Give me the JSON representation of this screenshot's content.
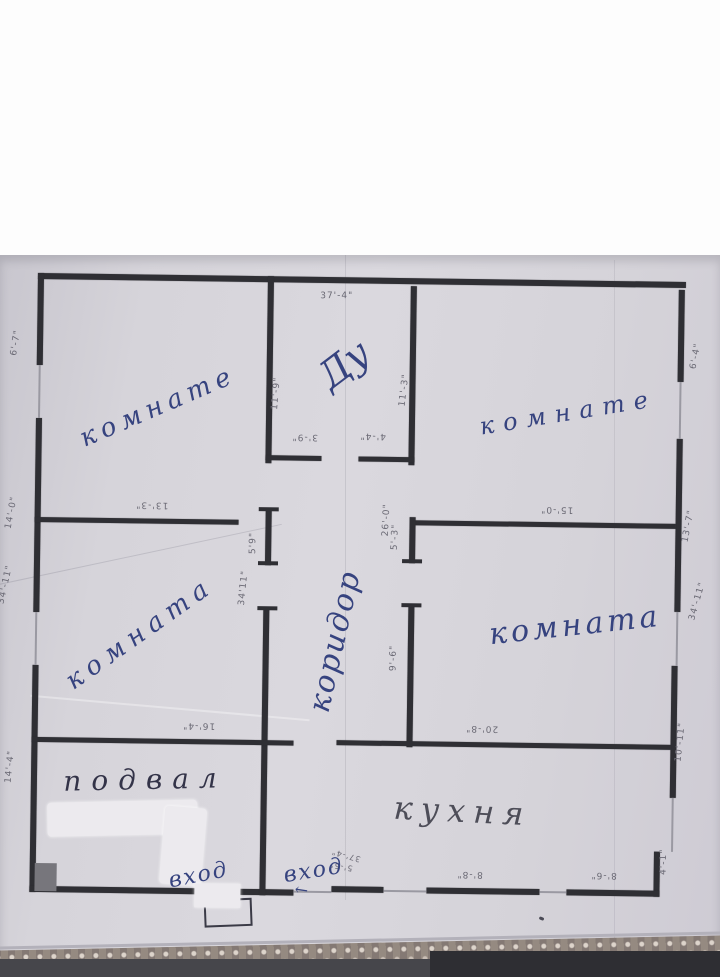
{
  "photo": {
    "description": "scanned hand-annotated floor plan",
    "paper_color": "#d6d4da",
    "wall_color": "#2f2f34",
    "ink_color": "#36437f",
    "pencil_color": "#6a6974"
  },
  "rooms": {
    "top_left": "комнате",
    "vestibule": "Ду",
    "top_right": "комнате",
    "mid_left": "комната",
    "corridor": "коридор",
    "mid_right": "комната",
    "basement": "подвал",
    "kitchen": "кухня"
  },
  "entrances": {
    "basement_door": "вход",
    "main_door": "вход",
    "arrow": "←"
  },
  "dims": {
    "top_width": "37'-4\"",
    "left_top": "6'-7\"",
    "right_top": "6'-4\"",
    "vest_left": "11'-9\"",
    "vest_right": "11'-3\"",
    "vest_door_l": "3'-9\"",
    "vest_door_r": "4'-4\"",
    "div_left": "13'-3\"",
    "left_mid": "14'-0\"",
    "left_total": "34'-11\"",
    "stub_left": "5'9\"",
    "corridor_total": "34'11\"",
    "corridor_len": "26'-0\"",
    "stub_right": "5'-3\"",
    "div_right": "15'-0\"",
    "right_mid": "13'-7\"",
    "right_total": "34'-11\"",
    "midright_wall": "9'-6\"",
    "basement_top": "16'-4\"",
    "left_bottom": "14'-4\"",
    "kitchen_top": "20'-8\"",
    "right_bottom": "10'-11\"",
    "corner_stub": "4'-1\"",
    "bottom_mid": "8'-8\"",
    "bottom_right": "8'-6\"",
    "note_a": "37'-4\"",
    "note_b": "5'-5\""
  }
}
